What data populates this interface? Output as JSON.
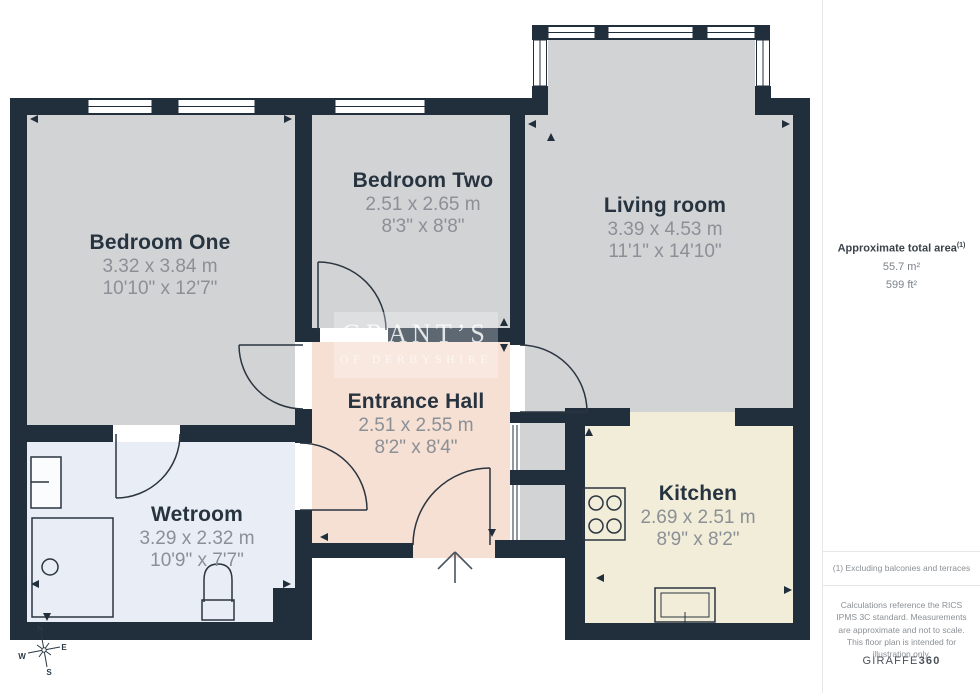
{
  "floorplan": {
    "rooms": [
      {
        "name": "Bedroom One",
        "metric": "3.32 x 3.84 m",
        "imperial": "10'10\" x 12'7\""
      },
      {
        "name": "Bedroom Two",
        "metric": "2.51 x 2.65 m",
        "imperial": "8'3\" x 8'8\""
      },
      {
        "name": "Living room",
        "metric": "3.39 x 4.53 m",
        "imperial": "11'1\" x 14'10\""
      },
      {
        "name": "Entrance Hall",
        "metric": "2.51 x 2.55 m",
        "imperial": "8'2\" x 8'4\""
      },
      {
        "name": "Wetroom",
        "metric": "3.29 x 2.32 m",
        "imperial": "10'9\" x 7'7\""
      },
      {
        "name": "Kitchen",
        "metric": "2.69 x 2.51 m",
        "imperial": "8'9\" x 8'2\""
      }
    ],
    "watermark": {
      "line1": "GRANT’S",
      "line2": "OF DERBYSHIRE"
    },
    "compass": {
      "n": "N",
      "e": "E",
      "s": "S",
      "w": "W"
    },
    "colors": {
      "walls": "#212f3d",
      "bedroom_floor": "#d2d3d5",
      "hall_floor": "#f6dfd3",
      "wetroom_floor": "#e9edf5",
      "kitchen_floor": "#f2edd8",
      "room_title_text": "#273440",
      "dimension_text": "#8b9096"
    }
  },
  "sidebar": {
    "area_label": "Approximate total area",
    "area_note_ref": "(1)",
    "area_metric": "55.7 m²",
    "area_imperial": "599 ft²",
    "footnote": "(1) Excluding balconies and terraces",
    "disclaimer": "Calculations reference the RICS IPMS 3C standard. Measurements are approximate and not to scale. This floor plan is intended for illustration only.",
    "brand": "GIRAFFE",
    "brand_suffix": "360"
  }
}
